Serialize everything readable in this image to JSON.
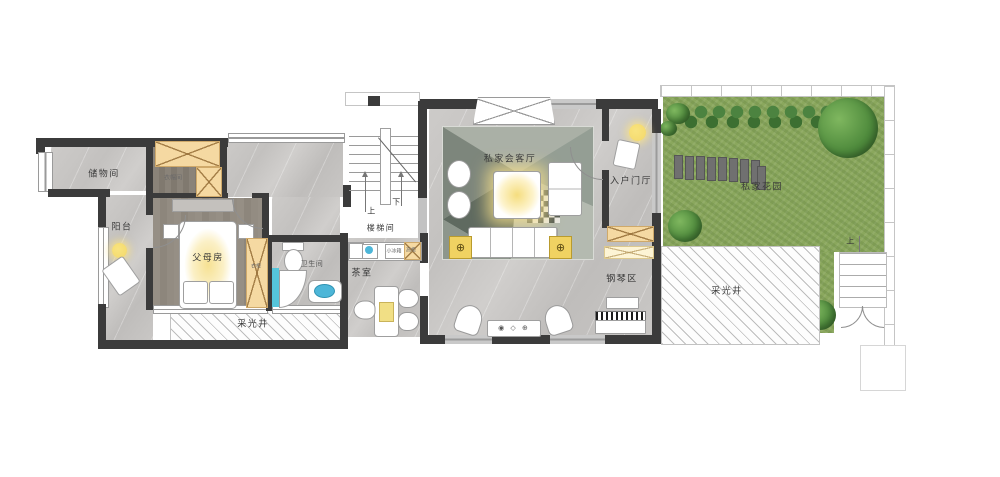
{
  "colors": {
    "wall": "#3b3b3b",
    "lawn": "#8aa75d",
    "closet": "#f5d9a2",
    "glow": "#f6e193",
    "accentYellow": "#f0d262",
    "water": "#4db6d8",
    "shower": "#55c5da",
    "label": "#3a3a3a"
  },
  "icons": {
    "lamp_symbol": "⊕",
    "media_glyphs": "◉ ◇ ⊕"
  },
  "rooms": {
    "storage": {
      "label": "储物间"
    },
    "balcony": {
      "label": "阳台"
    },
    "master_bedroom": {
      "label": "父母房"
    },
    "cloakroom": {
      "label": "衣帽间"
    },
    "wardrobe": {
      "label": "衣柜"
    },
    "bathroom": {
      "label": "卫生间"
    },
    "stairwell": {
      "label": "楼梯间",
      "up": "上",
      "down": "下"
    },
    "tea_room": {
      "label": "茶室",
      "fridge": "小冰箱",
      "tall_cabinet": "高柜"
    },
    "living_room": {
      "label": "私家会客厅"
    },
    "foyer": {
      "label": "入户门厅"
    },
    "piano_area": {
      "label": "钢琴区"
    },
    "lightwell_left": {
      "label": "采光井"
    },
    "lightwell_right": {
      "label": "采光井"
    },
    "garden": {
      "label": "私家花园",
      "up": "上"
    }
  }
}
